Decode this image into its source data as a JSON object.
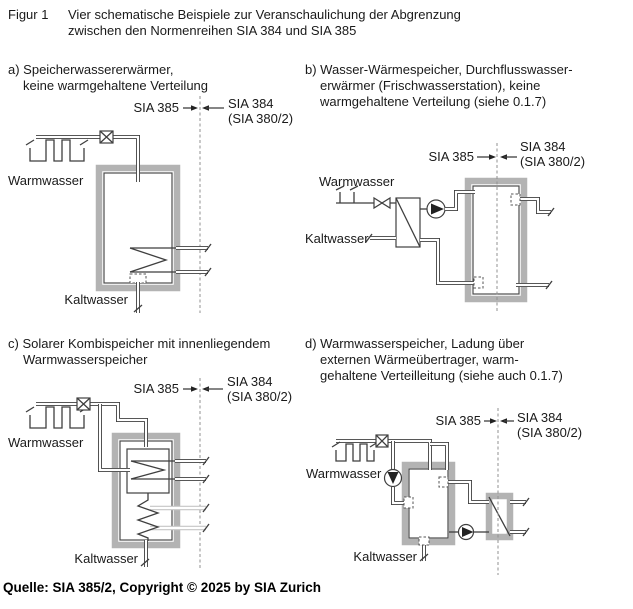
{
  "header": {
    "figure_label": "Figur 1",
    "title_line1": "Vier schematische Beispiele zur Veranschaulichung der Abgrenzung",
    "title_line2": "zwischen den Normenreihen SIA 384 und SIA 385"
  },
  "labels": {
    "sia385": "SIA 385",
    "sia384": "SIA 384",
    "sia380": "(SIA 380/2)",
    "warmwasser": "Warmwasser",
    "kaltwasser": "Kaltwasser"
  },
  "panels": {
    "a": {
      "caption_1": "a) Speicherwassererwärmer,",
      "caption_2": "keine warmgehaltene Verteilung"
    },
    "b": {
      "caption_1": "b) Wasser-Wärmespeicher, Durchflusswasser-",
      "caption_2": "erwärmer (Frischwasserstation), keine",
      "caption_3": "warmgehaltene Verteilung (siehe 0.1.7)"
    },
    "c": {
      "caption_1": "c) Solarer Kombispeicher mit innenliegendem",
      "caption_2": "Warmwasserspeicher"
    },
    "d": {
      "caption_1": "d) Warmwasserspeicher, Ladung über",
      "caption_2": "externen Wärmeübertrager, warm-",
      "caption_3": "gehaltene Verteilleitung (siehe auch 0.1.7)"
    }
  },
  "footer": {
    "source": "Quelle: SIA 385/2, Copyright © 2025 by SIA Zurich"
  },
  "colors": {
    "text": "#1a1a1a",
    "line": "#3f3f3f",
    "tank_border": "#b3b3b3",
    "solar_pipe": "#c6c6c6",
    "boundary_dash": "#909090"
  }
}
